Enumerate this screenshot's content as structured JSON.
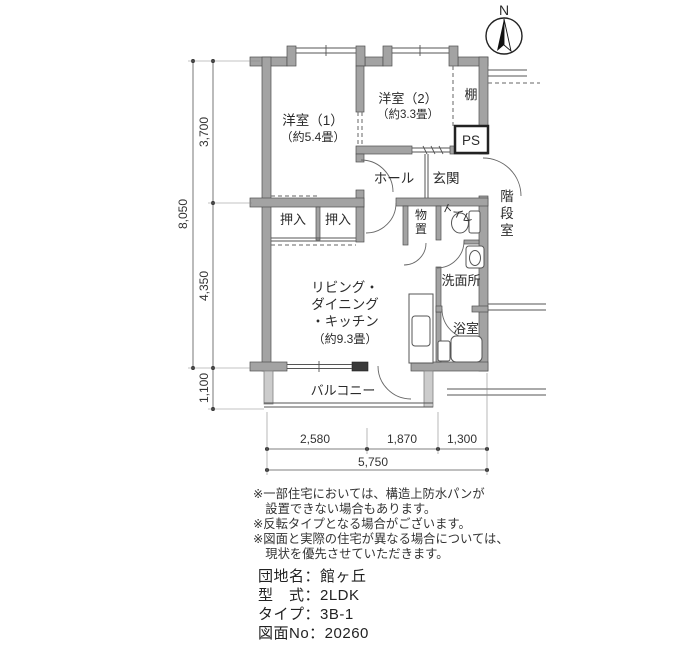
{
  "compass": {
    "north_label": "N"
  },
  "rooms": {
    "yoshitsu1_name": "洋室（1）",
    "yoshitsu1_size": "（約5.4畳）",
    "yoshitsu2_name": "洋室（2）",
    "yoshitsu2_size": "（約3.3畳）",
    "ldk_line1": "リビング・",
    "ldk_line2": "ダイニング",
    "ldk_line3": "・キッチン",
    "ldk_size": "（約9.3畳）",
    "hall": "ホール",
    "genkan": "玄関",
    "oshiire_left": "押入",
    "oshiire_right": "押入",
    "tana": "棚",
    "ps": "PS",
    "monooki_chars": [
      "物",
      "置"
    ],
    "toilet": "トイレ",
    "senmenjo": "洗面所",
    "yokushitsu": "浴室",
    "balcony": "バルコニー",
    "kaidanshitsu_chars": [
      "階",
      "段",
      "室"
    ]
  },
  "dimensions": {
    "left_total": "8,050",
    "left_upper": "3,700",
    "left_lower": "4,350",
    "left_balcony": "1,100",
    "bottom_seg1": "2,580",
    "bottom_seg2": "1,870",
    "bottom_seg3": "1,300",
    "bottom_total": "5,750"
  },
  "notes": [
    "※一部住宅においては、構造上防水パンが",
    "　設置できない場合もあります。",
    "※反転タイプとなる場合がございます。",
    "※図面と実際の住宅が異なる場合については、",
    "　現状を優先させていただきます。"
  ],
  "info": {
    "danchi": "団地名：館ヶ丘",
    "katashiki": "型　式：2LDK",
    "type": "タイプ：3B-1",
    "zumen_no": "図面No：20260"
  }
}
